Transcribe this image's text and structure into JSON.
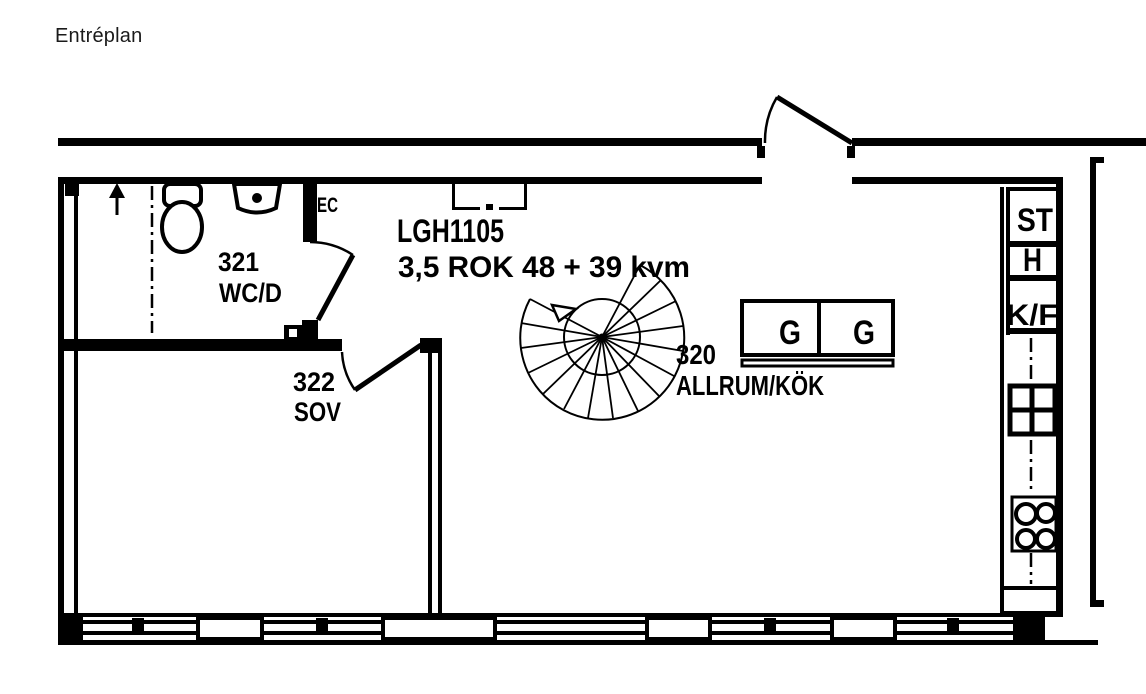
{
  "page": {
    "title": "Entréplan"
  },
  "apartment": {
    "id": "LGH1105",
    "spec": "3,5 ROK 48 + 39 kvm"
  },
  "rooms": {
    "wc": {
      "number": "321",
      "name": "WC/D"
    },
    "sov": {
      "number": "322",
      "name": "SOV"
    },
    "allrum": {
      "number": "320",
      "name": "ALLRUM/KÖK"
    }
  },
  "kitchen": {
    "st": "ST",
    "h": "H",
    "kf": "K/F"
  },
  "wardrobes": {
    "left": "G",
    "right": "G"
  },
  "labels": {
    "ec": "EC"
  },
  "icons": [
    "entry-arrow-icon",
    "toilet-icon",
    "washbasin-icon",
    "spiral-stair-icon",
    "kitchen-sink-icon",
    "stove-icon",
    "wardrobe-icon"
  ],
  "colors": {
    "line": "#000000",
    "background": "#ffffff"
  }
}
